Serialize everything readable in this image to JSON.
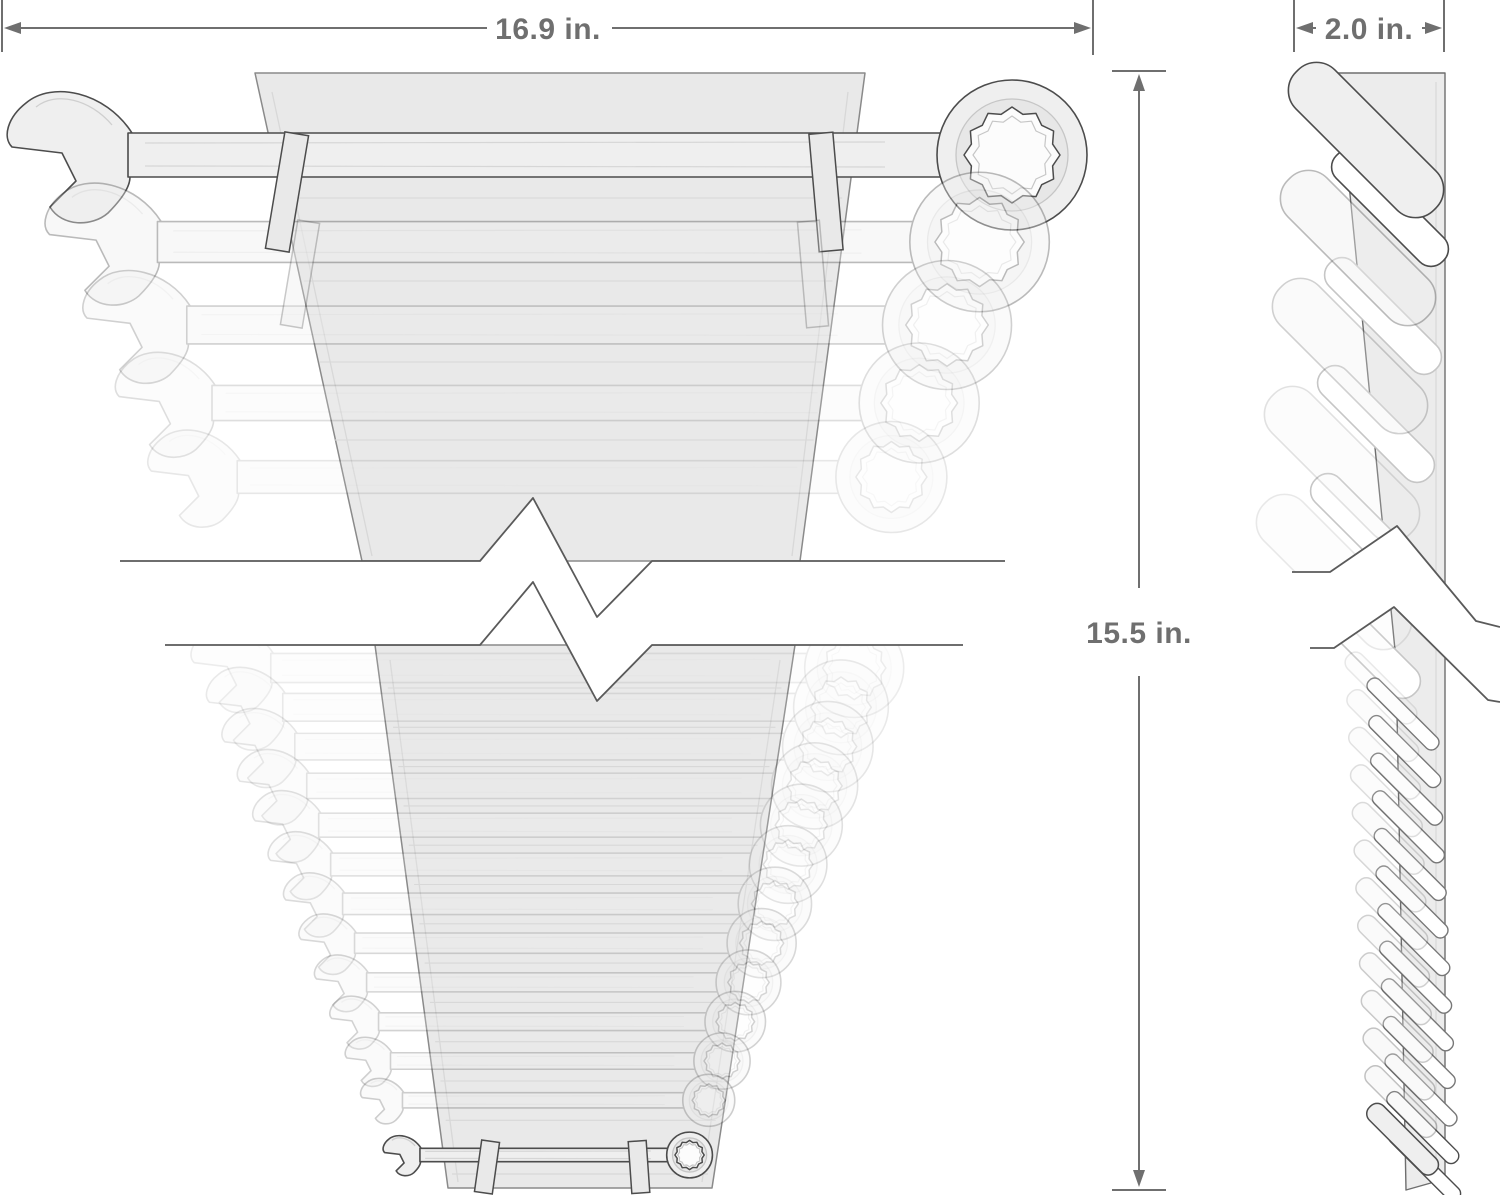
{
  "product_diagram": {
    "type": "wrench-organizer-dimension-drawing",
    "dimensions": {
      "width_label": "16.9 in.",
      "depth_label": "2.0 in.",
      "height_label": "15.5 in."
    },
    "front_view": {
      "upper_visible_wrenches": 5,
      "lower_visible_wrenches": 13
    },
    "side_view": {
      "upper_visible_slots": 5,
      "lower_visible_slots": 13
    },
    "colors": {
      "outline": "#4c4c4c",
      "ghost_line": "#c6c6c6",
      "tool_fill": "#efefef",
      "rack_fill": "#e9e9e9",
      "rack_edge": "#8a8a8a",
      "detail_line": "#d8d8d8",
      "dimension": "#6f6f6f",
      "break_line": "#5a5a5a",
      "background": "#ffffff"
    }
  }
}
